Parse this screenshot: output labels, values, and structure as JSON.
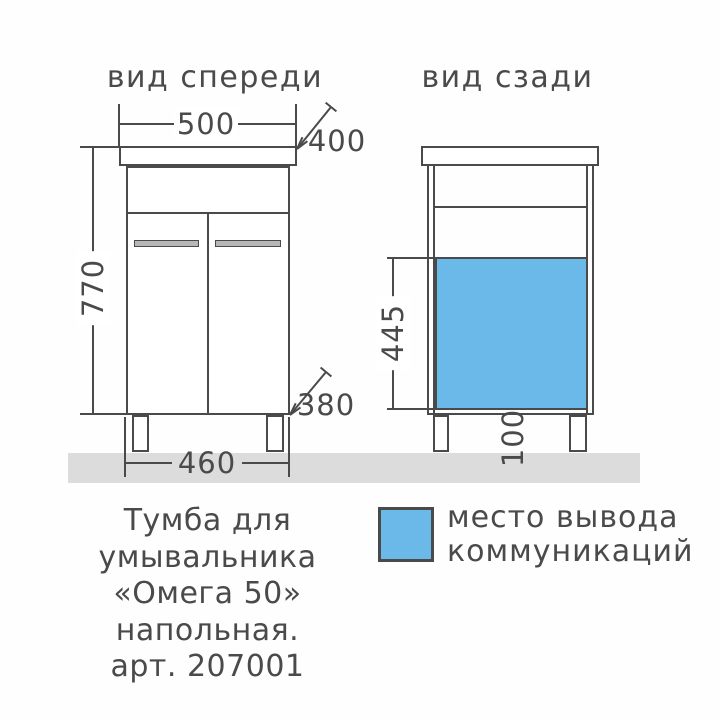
{
  "colors": {
    "accent-blue": "#6ab9e8",
    "floor-gray": "#dcdcdc",
    "line": "#4a4a4a",
    "text": "#4a4a4a"
  },
  "front_view": {
    "title": "вид спереди",
    "dims": {
      "width": "500",
      "depth_top": "400",
      "height": "770",
      "base_width": "460",
      "depth_bottom": "380"
    }
  },
  "back_view": {
    "title": "вид сзади",
    "dims": {
      "comm_zone_height": "445",
      "leg_height": "100"
    }
  },
  "legend": {
    "line1": "место вывода",
    "line2": "коммуникаций"
  },
  "caption": {
    "lines": [
      "Тумба для",
      "умывальника",
      "«Омега 50»",
      "напольная.",
      "арт. 207001"
    ]
  }
}
